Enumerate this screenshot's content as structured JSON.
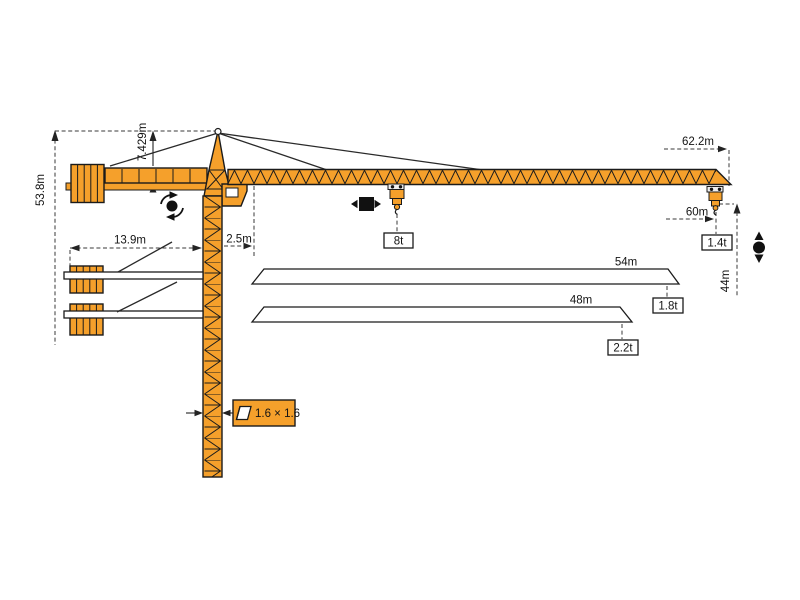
{
  "diagram_type": "tower-crane-dimension-and-load-diagram",
  "colors": {
    "crane_orange": "#F5A02B",
    "outline": "#1b1b1b",
    "dimension_lines": "#3a3a3a",
    "background": "#ffffff"
  },
  "labels": {
    "overall_height": "53.8m",
    "tower_head_height": "7.429m",
    "counter_jib_radius": "13.9m",
    "min_radius": "2.5m",
    "max_radius": "62.2m",
    "max_hook_radius": "60m",
    "tip_load": "1.4t",
    "hook_height": "44m",
    "max_load": "8t",
    "mast_section": "1.6 × 1.6"
  },
  "jib_variants": [
    {
      "length": "54m",
      "tip_load": "1.8t"
    },
    {
      "length": "48m",
      "tip_load": "2.2t"
    }
  ],
  "icons": {
    "slewing": "rotation-arrows-around-dot",
    "trolley_travel": "square-with-left-right-arrows",
    "hoisting": "dot-with-up-down-arrows",
    "mast_section_symbol": "cross-section-parallelogram"
  }
}
